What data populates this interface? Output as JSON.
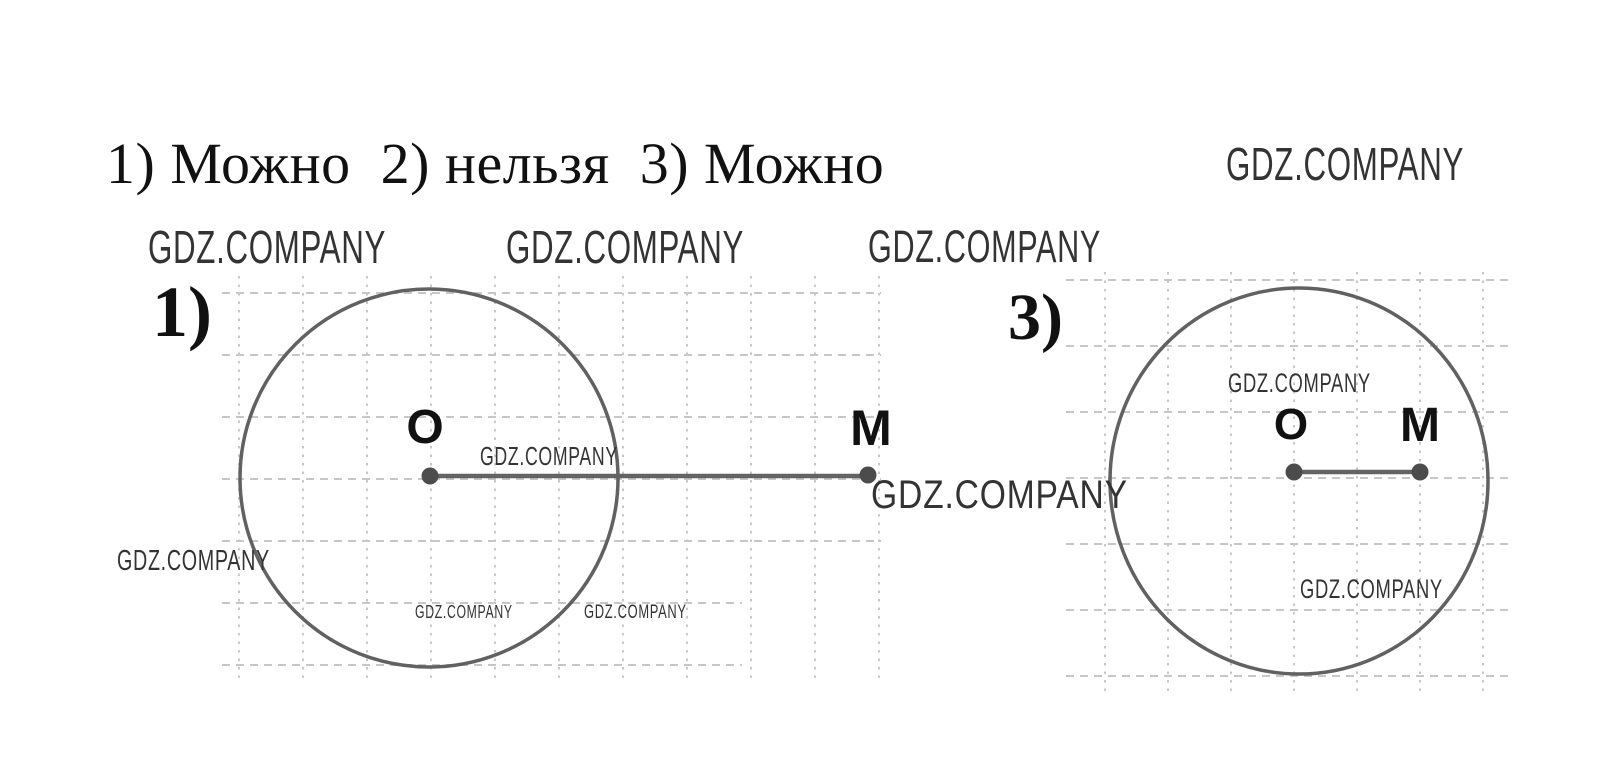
{
  "title": "1) Можно  2) нельзя  3) Можно",
  "watermark": "GDZ.COMPANY",
  "figures": {
    "fig1": {
      "label": "1)",
      "o_label": "O",
      "m_label": "M"
    },
    "fig3": {
      "label": "3)",
      "o_label": "O",
      "m_label": "M"
    }
  },
  "colors": {
    "background": "#ffffff",
    "text": "#111111",
    "watermark": "#333333",
    "grid": "#c7c7c7",
    "circle": "#616161",
    "segment": "#636363",
    "dot": "#4c4c4c"
  }
}
